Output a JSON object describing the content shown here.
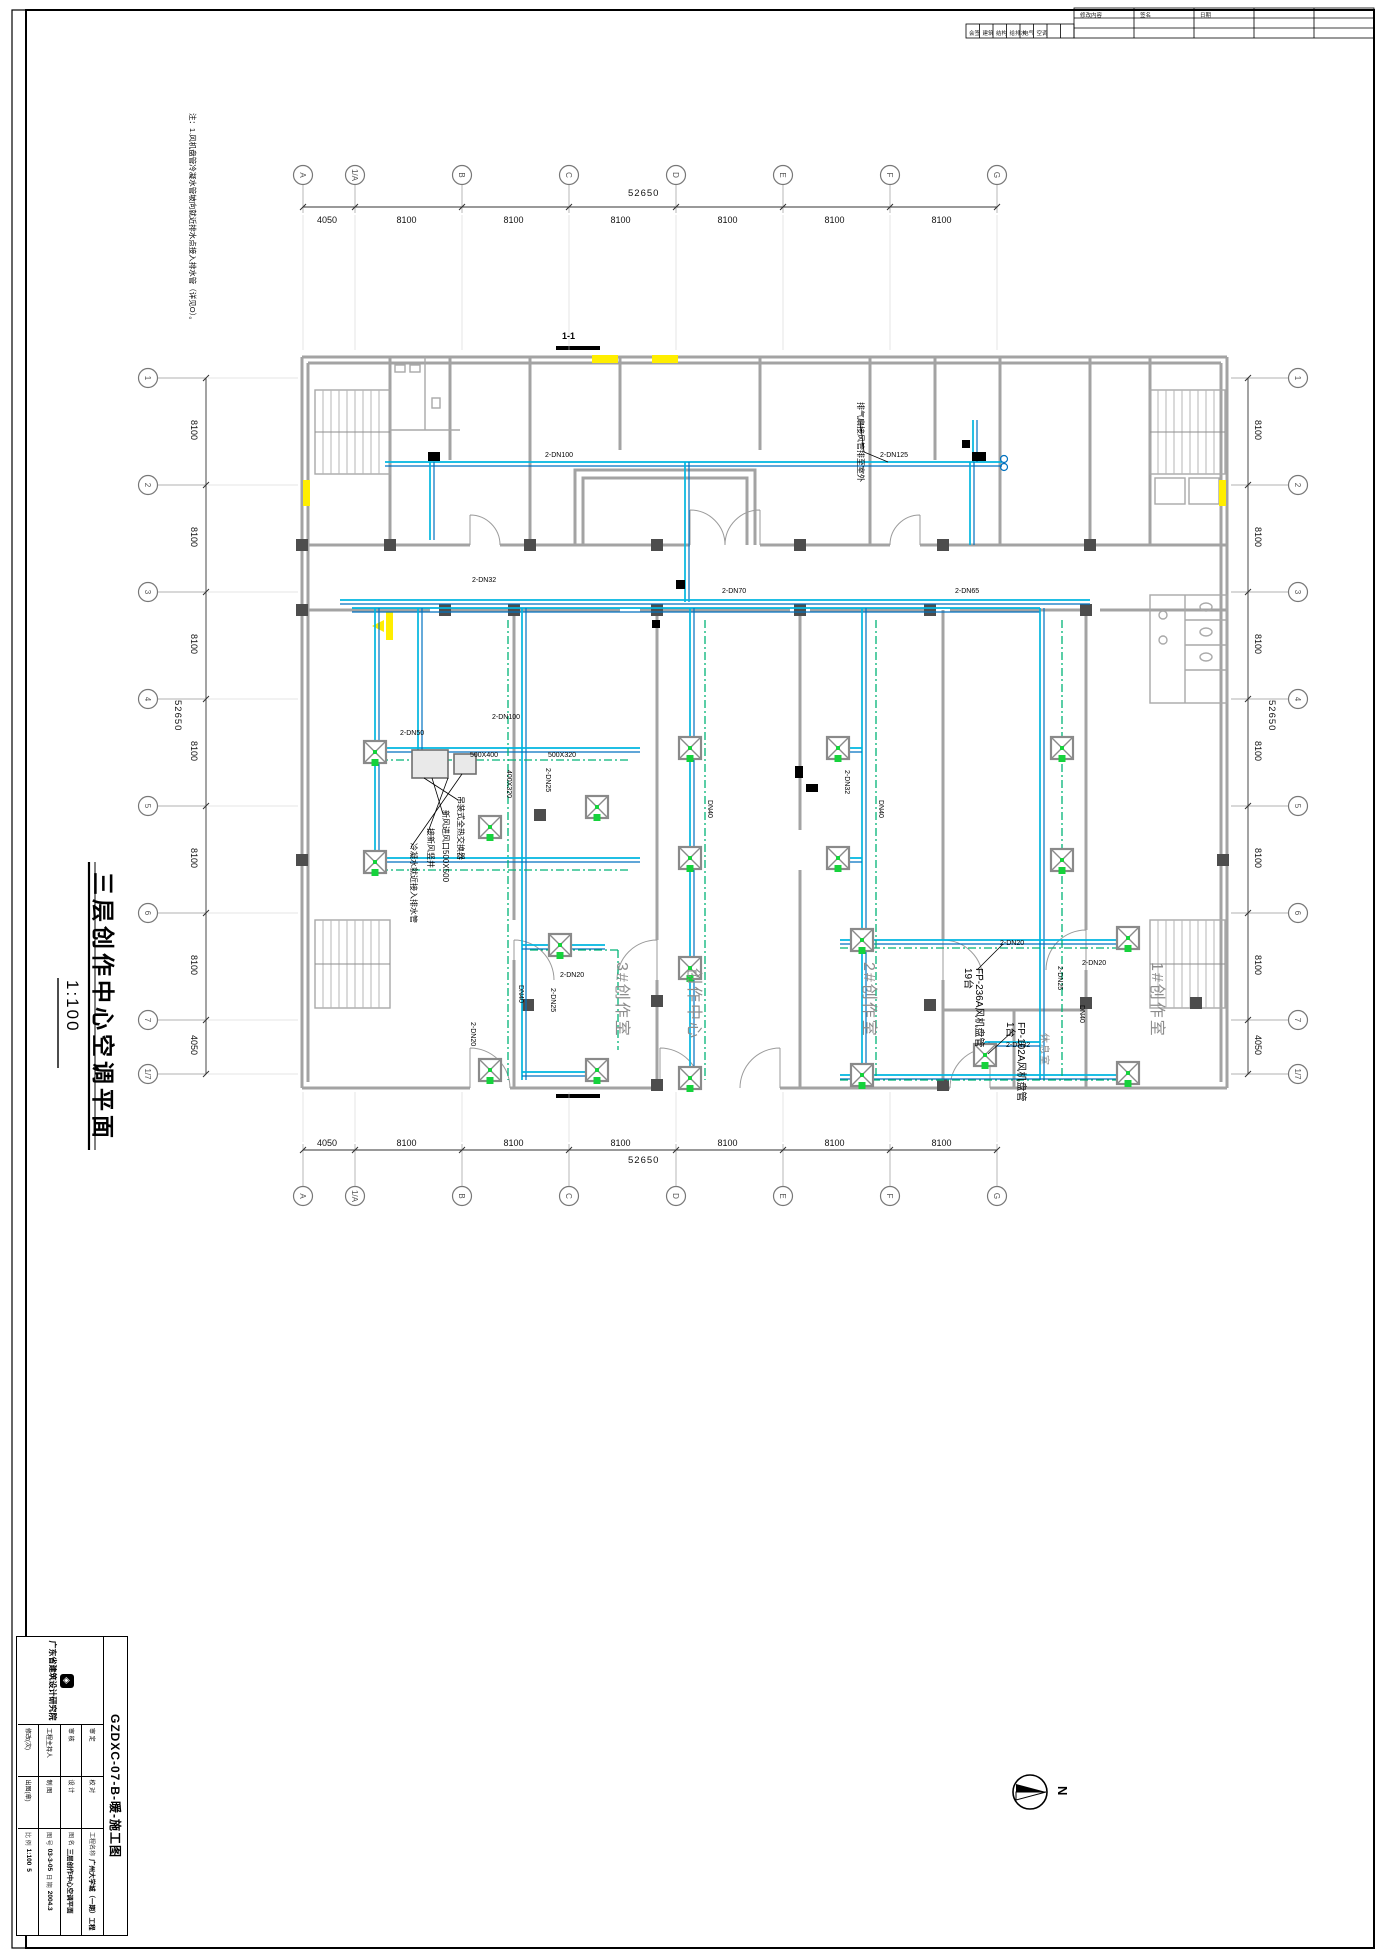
{
  "sheet": {
    "note": "注：1.风机盘管冷凝水管坡向就近排水点接入排水管（详见O）。",
    "title": "三层创作中心空调平面",
    "scale": "1:100",
    "section_mark": "1-1",
    "north_label": "N"
  },
  "grid": {
    "top_axes": [
      "A",
      "1/A",
      "B",
      "C",
      "D",
      "E",
      "F",
      "G"
    ],
    "side_axes": [
      "1",
      "2",
      "3",
      "4",
      "5",
      "6",
      "7",
      "1/7"
    ],
    "top_segments": [
      "4050",
      "8100",
      "8100",
      "8100",
      "8100",
      "8100",
      "8100"
    ],
    "side_segments": [
      "8100",
      "8100",
      "8100",
      "8100",
      "8100",
      "8100",
      "4050"
    ],
    "total": "52650"
  },
  "rooms": [
    "3#创作室",
    "创作中心",
    "2#创作室",
    "1#创作室",
    "休息室"
  ],
  "pipe_labels": [
    "2-DN100",
    "2-DN125",
    "2-DN50",
    "2-DN32",
    "2-DN70",
    "2-DN100",
    "500X400",
    "500X320",
    "400X320",
    "2-DN25",
    "2-DN20",
    "2-DN25",
    "DN40",
    "2-DN20",
    "2-DN20",
    "2-DN20",
    "2-DN25",
    "DN40",
    "2-DN32",
    "2-DN32",
    "DN40",
    "DN40",
    "2-DN65"
  ],
  "callouts": {
    "fcu1": [
      "FP-236A风机盘管",
      "19台"
    ],
    "fcu2": [
      "FP-102A风机盘管",
      "1台"
    ],
    "equipment": [
      "吊装式全热交换器",
      "新风进风口500X500",
      "接新风竖井",
      "冷凝水就近接入排水管"
    ],
    "exhaust": "排气扇接风管排至室外"
  },
  "title_block": {
    "serial": "GZDXC-07-B-暖-施工图",
    "company": "广东省建筑设计研究院",
    "fields": [
      "审 定",
      "校 对",
      "审 核",
      "设 计",
      "工程主持人",
      "制 图",
      "修改(次)",
      "出图(章)"
    ],
    "project_label": "工程名称",
    "project": "广州大学城（一期）工程",
    "drawing_label": "图 名",
    "drawing": "三层创作中心空调平面",
    "no_label": "图 号",
    "no": "03-3-05",
    "date_label": "日 期",
    "date": "2004.3",
    "scale_label": "比 例",
    "scale": "1:100",
    "page": "5"
  },
  "sign_strip": {
    "left_cells": [
      "会签",
      "建筑",
      "结构",
      "给排水",
      "电气",
      "空调"
    ],
    "right_cells": [
      "修改内容",
      "签名",
      "日期"
    ]
  }
}
